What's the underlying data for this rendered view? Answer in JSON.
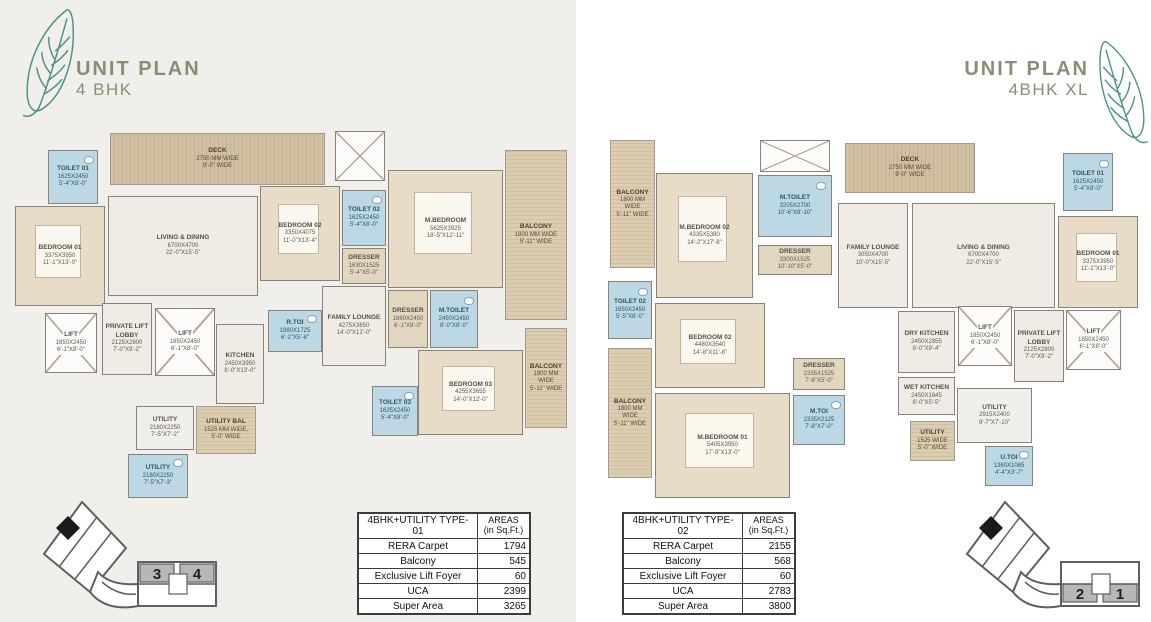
{
  "colors": {
    "title_text": "#8d8d76",
    "leaf_stroke": "#4f9180",
    "wall": "#8a8279",
    "bedroom_fill": "#e8dcc6",
    "toilet_fill": "#bdd8e5",
    "hall_fill": "#efece5",
    "deck_wood": "#c9b697",
    "keyplan_highlight": "#b7b7b7",
    "panel_left_bg": "#f0efec",
    "panel_right_bg": "#ffffff"
  },
  "panels": [
    {
      "title": "UNIT PLAN",
      "subtitle": "4 BHK",
      "table": {
        "name_header": "4BHK+UTILITY TYPE-01",
        "areas_header": "AREAS\n(in Sq.Ft.)",
        "rows": [
          [
            "RERA Carpet",
            "1794"
          ],
          [
            "Balcony",
            "545"
          ],
          [
            "Exclusive Lift Foyer",
            "60"
          ],
          [
            "UCA",
            "2399"
          ],
          [
            "Super Area",
            "3265"
          ]
        ]
      },
      "keyplan": {
        "units": [
          "3",
          "4"
        ]
      },
      "rooms": [
        {
          "name": "DECK",
          "mm": "2750 MM WIDE",
          "ft": "9'-0\" WIDE",
          "kind": "deck",
          "x": 100,
          "y": 5,
          "w": 215,
          "h": 52
        },
        {
          "name": "",
          "kind": "shaft",
          "x": 325,
          "y": 3,
          "w": 50,
          "h": 50
        },
        {
          "name": "BALCONY",
          "mm": "1800 MM WIDE",
          "ft": "5'-11\" WIDE",
          "kind": "balcony",
          "x": 495,
          "y": 22,
          "w": 62,
          "h": 170
        },
        {
          "name": "TOILET 01",
          "mm": "1625X2450",
          "ft": "5'-4\"X8'-0\"",
          "kind": "wet",
          "x": 38,
          "y": 22,
          "w": 50,
          "h": 54
        },
        {
          "name": "BEDROOM 01",
          "mm": "3375X3950",
          "ft": "11'-1\"X13'-0\"",
          "kind": "bed",
          "x": 5,
          "y": 78,
          "w": 90,
          "h": 100
        },
        {
          "name": "LIVING & DINING",
          "mm": "6700X4700",
          "ft": "22'-0\"X15'-5\"",
          "kind": "hall",
          "x": 98,
          "y": 68,
          "w": 150,
          "h": 100
        },
        {
          "name": "BEDROOM 02",
          "mm": "3350X4075",
          "ft": "11'-0\"X13'-4\"",
          "kind": "bed",
          "x": 250,
          "y": 58,
          "w": 80,
          "h": 95
        },
        {
          "name": "TOILET 02",
          "mm": "1625X2450",
          "ft": "5'-4\"X8'-0\"",
          "kind": "wet",
          "x": 332,
          "y": 62,
          "w": 44,
          "h": 56
        },
        {
          "name": "DRESSER",
          "mm": "1630X1525",
          "ft": "5'-4\"X5'-0\"",
          "kind": "dress",
          "x": 332,
          "y": 120,
          "w": 44,
          "h": 36
        },
        {
          "name": "FAMILY LOUNGE",
          "mm": "4275X3650",
          "ft": "14'-0\"X12'-0\"",
          "kind": "hall",
          "x": 312,
          "y": 158,
          "w": 64,
          "h": 80
        },
        {
          "name": "M.BEDROOM",
          "mm": "5625X3925",
          "ft": "18'-5\"X12'-11\"",
          "kind": "bed",
          "x": 378,
          "y": 42,
          "w": 115,
          "h": 118
        },
        {
          "name": "DRESSER",
          "mm": "1860X2450",
          "ft": "6'-1\"X8'-0\"",
          "kind": "dress",
          "x": 378,
          "y": 162,
          "w": 40,
          "h": 58
        },
        {
          "name": "M.TOILET",
          "mm": "2450X2450",
          "ft": "8'-0\"X8'-0\"",
          "kind": "wet",
          "x": 420,
          "y": 162,
          "w": 48,
          "h": 58
        },
        {
          "name": "BEDROOM 03",
          "mm": "4255X3655",
          "ft": "14'-0\"X12'-0\"",
          "kind": "bed",
          "x": 408,
          "y": 222,
          "w": 105,
          "h": 85
        },
        {
          "name": "BALCONY",
          "mm": "1800 MM WIDE",
          "ft": "5'-11\" WIDE",
          "kind": "balcony",
          "x": 515,
          "y": 200,
          "w": 42,
          "h": 100
        },
        {
          "name": "TOILET 03",
          "mm": "1625X2450",
          "ft": "5'-4\"X8'-0\"",
          "kind": "wet",
          "x": 362,
          "y": 258,
          "w": 46,
          "h": 50
        },
        {
          "name": "LIFT",
          "mm": "1850X2450",
          "ft": "6'-1\"X8'-0\"",
          "kind": "lift",
          "x": 35,
          "y": 185,
          "w": 52,
          "h": 60
        },
        {
          "name": "PRIVATE LIFT LOBBY",
          "mm": "2125X2800",
          "ft": "7'-0\"X9'-2\"",
          "kind": "hall",
          "x": 92,
          "y": 175,
          "w": 50,
          "h": 72
        },
        {
          "name": "LIFT",
          "mm": "1850X2450",
          "ft": "6'-1\"X8'-0\"",
          "kind": "lift",
          "x": 145,
          "y": 180,
          "w": 60,
          "h": 68
        },
        {
          "name": "KITCHEN",
          "mm": "2450X3950",
          "ft": "8'-0\"X13'-0\"",
          "kind": "hall",
          "x": 206,
          "y": 196,
          "w": 48,
          "h": 80
        },
        {
          "name": "R.TOI",
          "mm": "1880X1725",
          "ft": "6'-2\"X5'-8\"",
          "kind": "wet",
          "x": 258,
          "y": 182,
          "w": 54,
          "h": 42
        },
        {
          "name": "UTILITY",
          "mm": "2180X2250",
          "ft": "7'-5\"X7'-2\"",
          "kind": "service",
          "x": 126,
          "y": 278,
          "w": 58,
          "h": 44
        },
        {
          "name": "UTILITY BAL",
          "mm": "1525 MM WIDE,",
          "ft": "5'-0\" WIDE",
          "kind": "balcony",
          "x": 186,
          "y": 278,
          "w": 60,
          "h": 48
        },
        {
          "name": "UTILITY",
          "mm": "2180X2250",
          "ft": "7'-5\"X7'-3\"",
          "kind": "wet",
          "x": 118,
          "y": 326,
          "w": 60,
          "h": 44
        }
      ]
    },
    {
      "title": "UNIT PLAN",
      "subtitle": "4BHK XL",
      "table": {
        "name_header": "4BHK+UTILITY TYPE-02",
        "areas_header": "AREAS\n(in Sq.Ft.)",
        "rows": [
          [
            "RERA Carpet",
            "2155"
          ],
          [
            "Balcony",
            "568"
          ],
          [
            "Exclusive Lift Foyer",
            "60"
          ],
          [
            "UCA",
            "2783"
          ],
          [
            "Super Area",
            "3800"
          ]
        ]
      },
      "keyplan": {
        "units": [
          "2",
          "1"
        ]
      },
      "rooms": [
        {
          "name": "BALCONY",
          "mm": "1800 MM WIDE",
          "ft": "5'-11\" WIDE",
          "kind": "balcony",
          "x": 25,
          "y": 12,
          "w": 45,
          "h": 128
        },
        {
          "name": "M.BEDROOM 02",
          "mm": "4335X5380",
          "ft": "14'-2\"X17'-8\"",
          "kind": "bed",
          "x": 71,
          "y": 45,
          "w": 97,
          "h": 125
        },
        {
          "name": "",
          "kind": "shaft",
          "x": 175,
          "y": 12,
          "w": 70,
          "h": 32
        },
        {
          "name": "M.TOILET",
          "mm": "3205X2700",
          "ft": "10'-6\"X8'-10\"",
          "kind": "wet",
          "x": 173,
          "y": 47,
          "w": 74,
          "h": 62
        },
        {
          "name": "DRESSER",
          "mm": "3300X1525",
          "ft": "10'-10\"X5'-0\"",
          "kind": "dress",
          "x": 173,
          "y": 117,
          "w": 74,
          "h": 30
        },
        {
          "name": "DECK",
          "mm": "2750 MM WIDE",
          "ft": "9'-0\" WIDE",
          "kind": "deck",
          "x": 260,
          "y": 15,
          "w": 130,
          "h": 50
        },
        {
          "name": "FAMILY LOUNGE",
          "mm": "3050X4700",
          "ft": "10'-0\"X15'-5\"",
          "kind": "hall",
          "x": 253,
          "y": 75,
          "w": 70,
          "h": 105
        },
        {
          "name": "LIVING & DINING",
          "mm": "6700X4700",
          "ft": "22'-0\"X15'-5\"",
          "kind": "hall",
          "x": 327,
          "y": 75,
          "w": 143,
          "h": 105
        },
        {
          "name": "TOILET 01",
          "mm": "1625X2450",
          "ft": "5'-4\"X8'-0\"",
          "kind": "wet",
          "x": 478,
          "y": 25,
          "w": 50,
          "h": 58
        },
        {
          "name": "BEDROOM 01",
          "mm": "3375X3950",
          "ft": "11'-1\"X13'-0\"",
          "kind": "bed",
          "x": 473,
          "y": 88,
          "w": 80,
          "h": 92
        },
        {
          "name": "TOILET 02",
          "mm": "1650X2450",
          "ft": "5'-5\"X8'-0\"",
          "kind": "wet",
          "x": 23,
          "y": 153,
          "w": 44,
          "h": 58
        },
        {
          "name": "BEDROOM 02",
          "mm": "4480X3540",
          "ft": "14'-8\"X11'-8\"",
          "kind": "bed",
          "x": 70,
          "y": 175,
          "w": 110,
          "h": 85
        },
        {
          "name": "BALCONY",
          "mm": "1800 MM WIDE",
          "ft": "5'-11\" WIDE",
          "kind": "balcony",
          "x": 23,
          "y": 220,
          "w": 44,
          "h": 130
        },
        {
          "name": "M.BEDROOM 01",
          "mm": "5405X3950",
          "ft": "17'-9\"X13'-0\"",
          "kind": "bed",
          "x": 70,
          "y": 265,
          "w": 135,
          "h": 105
        },
        {
          "name": "DRESSER",
          "mm": "2335X1525",
          "ft": "7'-8\"X5'-0\"",
          "kind": "dress",
          "x": 208,
          "y": 230,
          "w": 52,
          "h": 32
        },
        {
          "name": "M.TOI",
          "mm": "2335X2125",
          "ft": "7'-8\"X7'-0\"",
          "kind": "wet",
          "x": 208,
          "y": 267,
          "w": 52,
          "h": 50
        },
        {
          "name": "DRY KITCHEN",
          "mm": "2450X2855",
          "ft": "8'-0\"X9'-4\"",
          "kind": "hall",
          "x": 313,
          "y": 183,
          "w": 57,
          "h": 62
        },
        {
          "name": "WET KITCHEN",
          "mm": "2450X1645",
          "ft": "8'-0\"X5'-5\"",
          "kind": "hall",
          "x": 313,
          "y": 249,
          "w": 57,
          "h": 38
        },
        {
          "name": "LIFT",
          "mm": "1850X2450",
          "ft": "6'-1\"X8'-0\"",
          "kind": "lift",
          "x": 373,
          "y": 178,
          "w": 54,
          "h": 60
        },
        {
          "name": "PRIVATE LIFT LOBBY",
          "mm": "2125X2800",
          "ft": "7'-0\"X9'-2\"",
          "kind": "hall",
          "x": 429,
          "y": 182,
          "w": 50,
          "h": 72
        },
        {
          "name": "LIFT",
          "mm": "1850X2450",
          "ft": "6'-1\"X8'-0\"",
          "kind": "lift",
          "x": 481,
          "y": 182,
          "w": 55,
          "h": 60
        },
        {
          "name": "UTILITY",
          "mm": "2915X2400",
          "ft": "9'-7\"X7'-10\"",
          "kind": "service",
          "x": 372,
          "y": 260,
          "w": 75,
          "h": 55
        },
        {
          "name": "UTILITY",
          "mm": "1525 WIDE",
          "ft": "5'-0\" WIDE",
          "kind": "balcony",
          "x": 325,
          "y": 293,
          "w": 45,
          "h": 40
        },
        {
          "name": "U.TOI",
          "mm": "1360X1085",
          "ft": "4'-4\"X3'-7\"",
          "kind": "wet",
          "x": 400,
          "y": 318,
          "w": 48,
          "h": 40
        }
      ]
    }
  ]
}
